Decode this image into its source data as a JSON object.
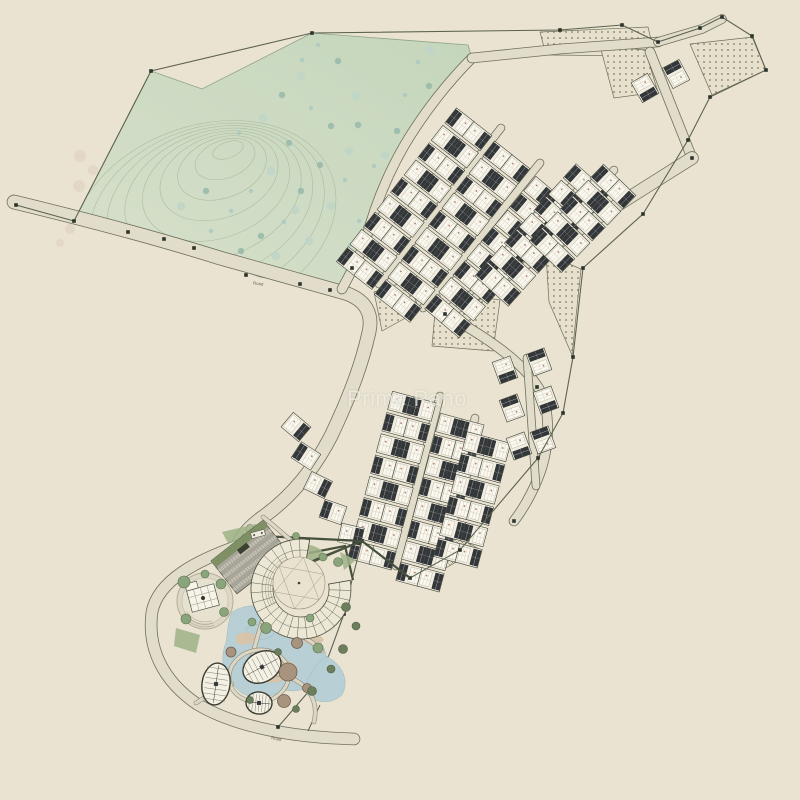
{
  "watermark": {
    "text": "Prime Pano"
  },
  "road_labels": [
    {
      "text": "Road",
      "x": 258,
      "y": 285,
      "rotate": 8
    },
    {
      "text": "Road",
      "x": 276,
      "y": 740,
      "rotate": 11
    }
  ],
  "palette": {
    "background": "#eae3d1",
    "green_light": "#d8e0cb",
    "green_dark": "#c4d6bc",
    "contour": "#a6b698",
    "road_fill": "#e2dcca",
    "road_casing": "#6e705c",
    "plot_fill": "#f1ede0",
    "plot_stroke": "#3e4337",
    "roof": "#33373a",
    "boundary": "#5c6350",
    "marker": "#2c332a",
    "hatch_dot": "#7d7a5f",
    "hedge": "#46503c",
    "lagoon": "#b6cfd6",
    "sand": "#d9c2a6",
    "lawn": "#9db287",
    "tree_sage": "#8aa57c",
    "tree_dark": "#6c7e5c",
    "parking": "#a7a499",
    "building_ring": "#ede7d5",
    "blob_brown": "#a8937f"
  },
  "plan": {
    "canvas": {
      "w": 800,
      "h": 800
    },
    "green_area": {
      "points": "151,71 202,89 312,33 468,45 472,58 448,82 422,112 403,143 388,178 375,210 366,240 352,268 341,288 330,290 300,283 260,277 230,266 200,250 164,239 128,232 74,221"
    },
    "contours": {
      "cx": 228,
      "cy": 150,
      "n": 9,
      "rx0": 16,
      "ry0": 8,
      "drx": 15,
      "dry": 11,
      "dcx": -3,
      "dcy": 9,
      "rot": -20
    },
    "green_trees": [
      [
        318,
        45
      ],
      [
        338,
        61
      ],
      [
        301,
        76
      ],
      [
        418,
        62
      ],
      [
        429,
        86
      ],
      [
        356,
        96
      ],
      [
        311,
        108
      ],
      [
        331,
        126
      ],
      [
        263,
        118
      ],
      [
        239,
        133
      ],
      [
        289,
        143
      ],
      [
        349,
        151
      ],
      [
        374,
        166
      ],
      [
        397,
        131
      ],
      [
        271,
        171
      ],
      [
        251,
        191
      ],
      [
        301,
        191
      ],
      [
        331,
        206
      ],
      [
        359,
        221
      ],
      [
        388,
        201
      ],
      [
        414,
        176
      ],
      [
        284,
        222
      ],
      [
        261,
        236
      ],
      [
        309,
        241
      ],
      [
        231,
        211
      ],
      [
        206,
        191
      ],
      [
        181,
        206
      ],
      [
        211,
        231
      ],
      [
        241,
        251
      ],
      [
        276,
        256
      ],
      [
        302,
        60
      ],
      [
        282,
        95
      ],
      [
        430,
        50
      ],
      [
        405,
        95
      ],
      [
        358,
        125
      ],
      [
        385,
        155
      ],
      [
        345,
        180
      ],
      [
        320,
        165
      ],
      [
        295,
        210
      ],
      [
        350,
        245
      ]
    ],
    "bg_trees": [
      [
        80,
        156,
        6
      ],
      [
        93,
        170,
        5
      ],
      [
        79,
        186,
        6
      ],
      [
        95,
        199,
        5
      ],
      [
        84,
        214,
        6
      ],
      [
        70,
        229,
        5
      ],
      [
        60,
        243,
        4
      ]
    ],
    "boundary_lines": [
      "16,205 74,221 151,71 312,33 560,30 622,25 658,42 700,28 722,17 752,36 766,70 710,97 688,140 643,214 583,268 573,357 563,413 538,458 460,550 410,578 362,541 300,568",
      "362,541 352,580 344,614 329,655 309,691 285,719 278,727"
    ],
    "markers": [
      [
        16,
        205
      ],
      [
        74,
        221
      ],
      [
        151,
        71
      ],
      [
        312,
        33
      ],
      [
        560,
        30
      ],
      [
        622,
        25
      ],
      [
        658,
        42
      ],
      [
        700,
        28
      ],
      [
        722,
        17
      ],
      [
        752,
        36
      ],
      [
        766,
        70
      ],
      [
        710,
        97
      ],
      [
        688,
        140
      ],
      [
        643,
        214
      ],
      [
        583,
        268
      ],
      [
        573,
        357
      ],
      [
        563,
        413
      ],
      [
        538,
        458
      ],
      [
        460,
        550
      ],
      [
        410,
        578
      ],
      [
        362,
        541
      ],
      [
        128,
        232
      ],
      [
        164,
        239
      ],
      [
        194,
        248
      ],
      [
        246,
        275
      ],
      [
        300,
        284
      ],
      [
        330,
        290
      ],
      [
        352,
        268
      ],
      [
        445,
        314
      ],
      [
        692,
        158
      ],
      [
        344,
        614
      ],
      [
        308,
        692
      ],
      [
        278,
        727
      ],
      [
        537,
        387
      ],
      [
        514,
        521
      ]
    ],
    "roads": [
      {
        "d": "M 14,202 C 80,218 150,236 220,258 C 270,272 312,284 345,293 C 366,300 373,314 369,332 C 362,364 350,396 331,436 C 313,471 291,497 263,517 C 249,527 241,537 238,546",
        "w": 13
      },
      {
        "d": "M 238,546 C 198,560 158,580 152,612 C 147,648 163,681 197,704 C 232,725 282,735 332,738 L 354,739",
        "w": 11
      },
      {
        "d": "M 472,58 C 449,81 424,112 404,146 C 389,172 375,205 366,239 C 360,256 352,270 342,289",
        "w": 9
      },
      {
        "d": "M 658,42 L 560,49 L 472,58",
        "w": 9
      },
      {
        "d": "M 658,42 L 702,29 L 722,19",
        "w": 8
      },
      {
        "d": "M 650,52 L 692,158",
        "w": 9
      },
      {
        "d": "M 692,158 L 445,314",
        "w": 12
      },
      {
        "d": "M 445,314 C 488,338 521,361 538,387 C 549,404 551,437 542,467 C 537,483 527,504 514,521",
        "w": 9
      },
      {
        "d": "M 379,284 L 501,128",
        "w": 7
      },
      {
        "d": "M 423,308 L 540,163",
        "w": 7
      },
      {
        "d": "M 473,300 L 581,175",
        "w": 7
      },
      {
        "d": "M 525,267 L 614,170",
        "w": 7
      },
      {
        "d": "M 396,566 L 440,396",
        "w": 7
      },
      {
        "d": "M 439,565 L 475,418",
        "w": 7
      },
      {
        "d": "M 527,358 L 536,486",
        "w": 7
      },
      {
        "d": "M 250,528 L 252,548",
        "w": 6
      }
    ],
    "hatch_dotted": [
      "540,32 648,27 655,56 546,55",
      "690,44 753,37 766,70 712,95",
      "600,46 645,50 658,92 614,98",
      "374,292 407,281 420,310 382,331",
      "437,290 500,300 493,351 432,346",
      "546,254 581,269 572,355 549,302"
    ],
    "hatch_cross": [
      "438,526 479,549 444,569"
    ],
    "strips": [
      {
        "x": 360,
        "y": 268,
        "angle": -52,
        "n": 9,
        "double": true
      },
      {
        "x": 398,
        "y": 301,
        "angle": -52,
        "n": 9,
        "double": true
      },
      {
        "x": 448,
        "y": 316,
        "angle": -50,
        "n": 8,
        "double": true
      },
      {
        "x": 498,
        "y": 284,
        "angle": -48,
        "n": 7,
        "double": true
      },
      {
        "x": 552,
        "y": 250,
        "angle": -46,
        "n": 5,
        "double": true
      },
      {
        "x": 372,
        "y": 555,
        "angle": -75,
        "n": 8,
        "double": true
      },
      {
        "x": 420,
        "y": 577,
        "angle": -75,
        "n": 8,
        "double": true
      },
      {
        "x": 458,
        "y": 553,
        "angle": -75,
        "n": 6,
        "double": true
      }
    ],
    "single_plots": [
      [
        296,
        427,
        -50,
        1
      ],
      [
        306,
        456,
        -57,
        -1
      ],
      [
        318,
        485,
        -64,
        1
      ],
      [
        333,
        512,
        -71,
        -1
      ],
      [
        351,
        535,
        -77,
        1
      ],
      [
        645,
        88,
        -30,
        1
      ],
      [
        676,
        74,
        -28,
        -1
      ],
      [
        505,
        370,
        -20,
        1
      ],
      [
        539,
        362,
        -20,
        -1
      ],
      [
        512,
        408,
        -20,
        -1
      ],
      [
        546,
        400,
        -20,
        1
      ],
      [
        519,
        446,
        -20,
        1
      ],
      [
        543,
        440,
        -20,
        -1
      ]
    ],
    "hedges": [
      "M 242,535 L 362,541",
      "M 292,569 L 362,541",
      "M 362,541 L 410,578",
      "M 309,553 L 345,546 L 353,580"
    ],
    "leader_line": "M 320,705 L 308,731",
    "resort": {
      "parking": {
        "cx": 250,
        "cy": 557,
        "rot": -38,
        "w": 66,
        "h": 42
      },
      "amphitheater": {
        "cx": 301,
        "cy": 589,
        "rOut": 50,
        "rIn": 28,
        "startDeg": -10,
        "endDeg": 280,
        "courtyard": {
          "cx": 299,
          "cy": 583,
          "r": 26
        }
      },
      "club": {
        "cx": 205,
        "cy": 601,
        "r": 28
      },
      "gate": {
        "cx": 258,
        "cy": 534,
        "rot": -15
      },
      "oval_loop": {
        "cx": 259,
        "cy": 676,
        "rx": 30,
        "ry": 26,
        "rot": -10
      },
      "ovals": [
        {
          "cx": 216,
          "cy": 684,
          "rx": 14,
          "ry": 21,
          "rot": 8
        },
        {
          "cx": 262,
          "cy": 667,
          "rx": 20,
          "ry": 15,
          "rot": -28
        },
        {
          "cx": 259,
          "cy": 703,
          "rx": 13,
          "ry": 11,
          "rot": 5
        }
      ],
      "blobs": [
        [
          288,
          672,
          9
        ],
        [
          297,
          643,
          5.5
        ],
        [
          284,
          701,
          6.5
        ],
        [
          307,
          688,
          4.5
        ],
        [
          231,
          652,
          5
        ]
      ],
      "lagoon": [
        "M 232,612 C 252,600 278,606 294,622 C 312,630 328,644 326,662 C 322,684 304,694 284,690 C 268,700 246,700 236,688 C 222,676 220,658 226,642 C 228,630 228,620 232,612 Z",
        "M 326,656 C 342,664 350,680 342,695 C 330,706 312,703 305,691 C 306,678 315,665 326,656 Z",
        "M 246,628 C 258,622 270,624 276,632 C 270,640 256,642 248,638 Z"
      ],
      "sand": [
        "M 252,664 C 266,652 288,656 298,668 C 292,682 272,686 258,680 C 250,676 248,670 252,664 Z",
        "M 236,636 C 244,630 254,632 258,638 C 252,646 240,646 236,642 Z",
        "M 300,636 C 310,630 320,633 324,640 C 318,648 304,646 300,636 Z"
      ],
      "lawns": [
        "M 286,548 C 300,541 316,544 323,552 C 316,562 299,566 289,559 Z",
        "M 176,628 L 200,635 L 196,653 L 174,646 Z",
        "M 222,532 L 256,524 L 262,534 L 228,543 Z",
        "M 340,552 L 356,560 L 344,570 Z"
      ],
      "walkways": [
        "M 263,517 C 281,531 296,546 307,552",
        "M 250,560 C 262,580 268,600 262,622 C 256,642 250,658 252,676",
        "M 252,676 C 268,671 286,673 300,683 C 312,691 318,706 314,722",
        "M 262,622 C 286,626 308,637 322,651",
        "M 196,703 C 210,694 220,688 232,684"
      ],
      "trees_sage": [
        [
          184,
          582,
          6
        ],
        [
          221,
          584,
          5
        ],
        [
          224,
          612,
          4.5
        ],
        [
          186,
          619,
          5
        ],
        [
          205,
          574,
          4
        ],
        [
          266,
          628,
          5.5
        ],
        [
          252,
          622,
          4
        ],
        [
          318,
          648,
          5
        ],
        [
          338,
          562,
          4.5
        ],
        [
          323,
          557,
          4
        ],
        [
          296,
          536,
          3.5
        ],
        [
          310,
          618,
          4
        ]
      ],
      "trees_dark": [
        [
          346,
          607,
          4.5
        ],
        [
          356,
          626,
          4
        ],
        [
          343,
          649,
          4.5
        ],
        [
          331,
          669,
          4
        ],
        [
          312,
          691,
          4.5
        ],
        [
          296,
          709,
          3.5
        ],
        [
          278,
          652,
          3.5
        ],
        [
          250,
          700,
          3.5
        ]
      ]
    }
  }
}
